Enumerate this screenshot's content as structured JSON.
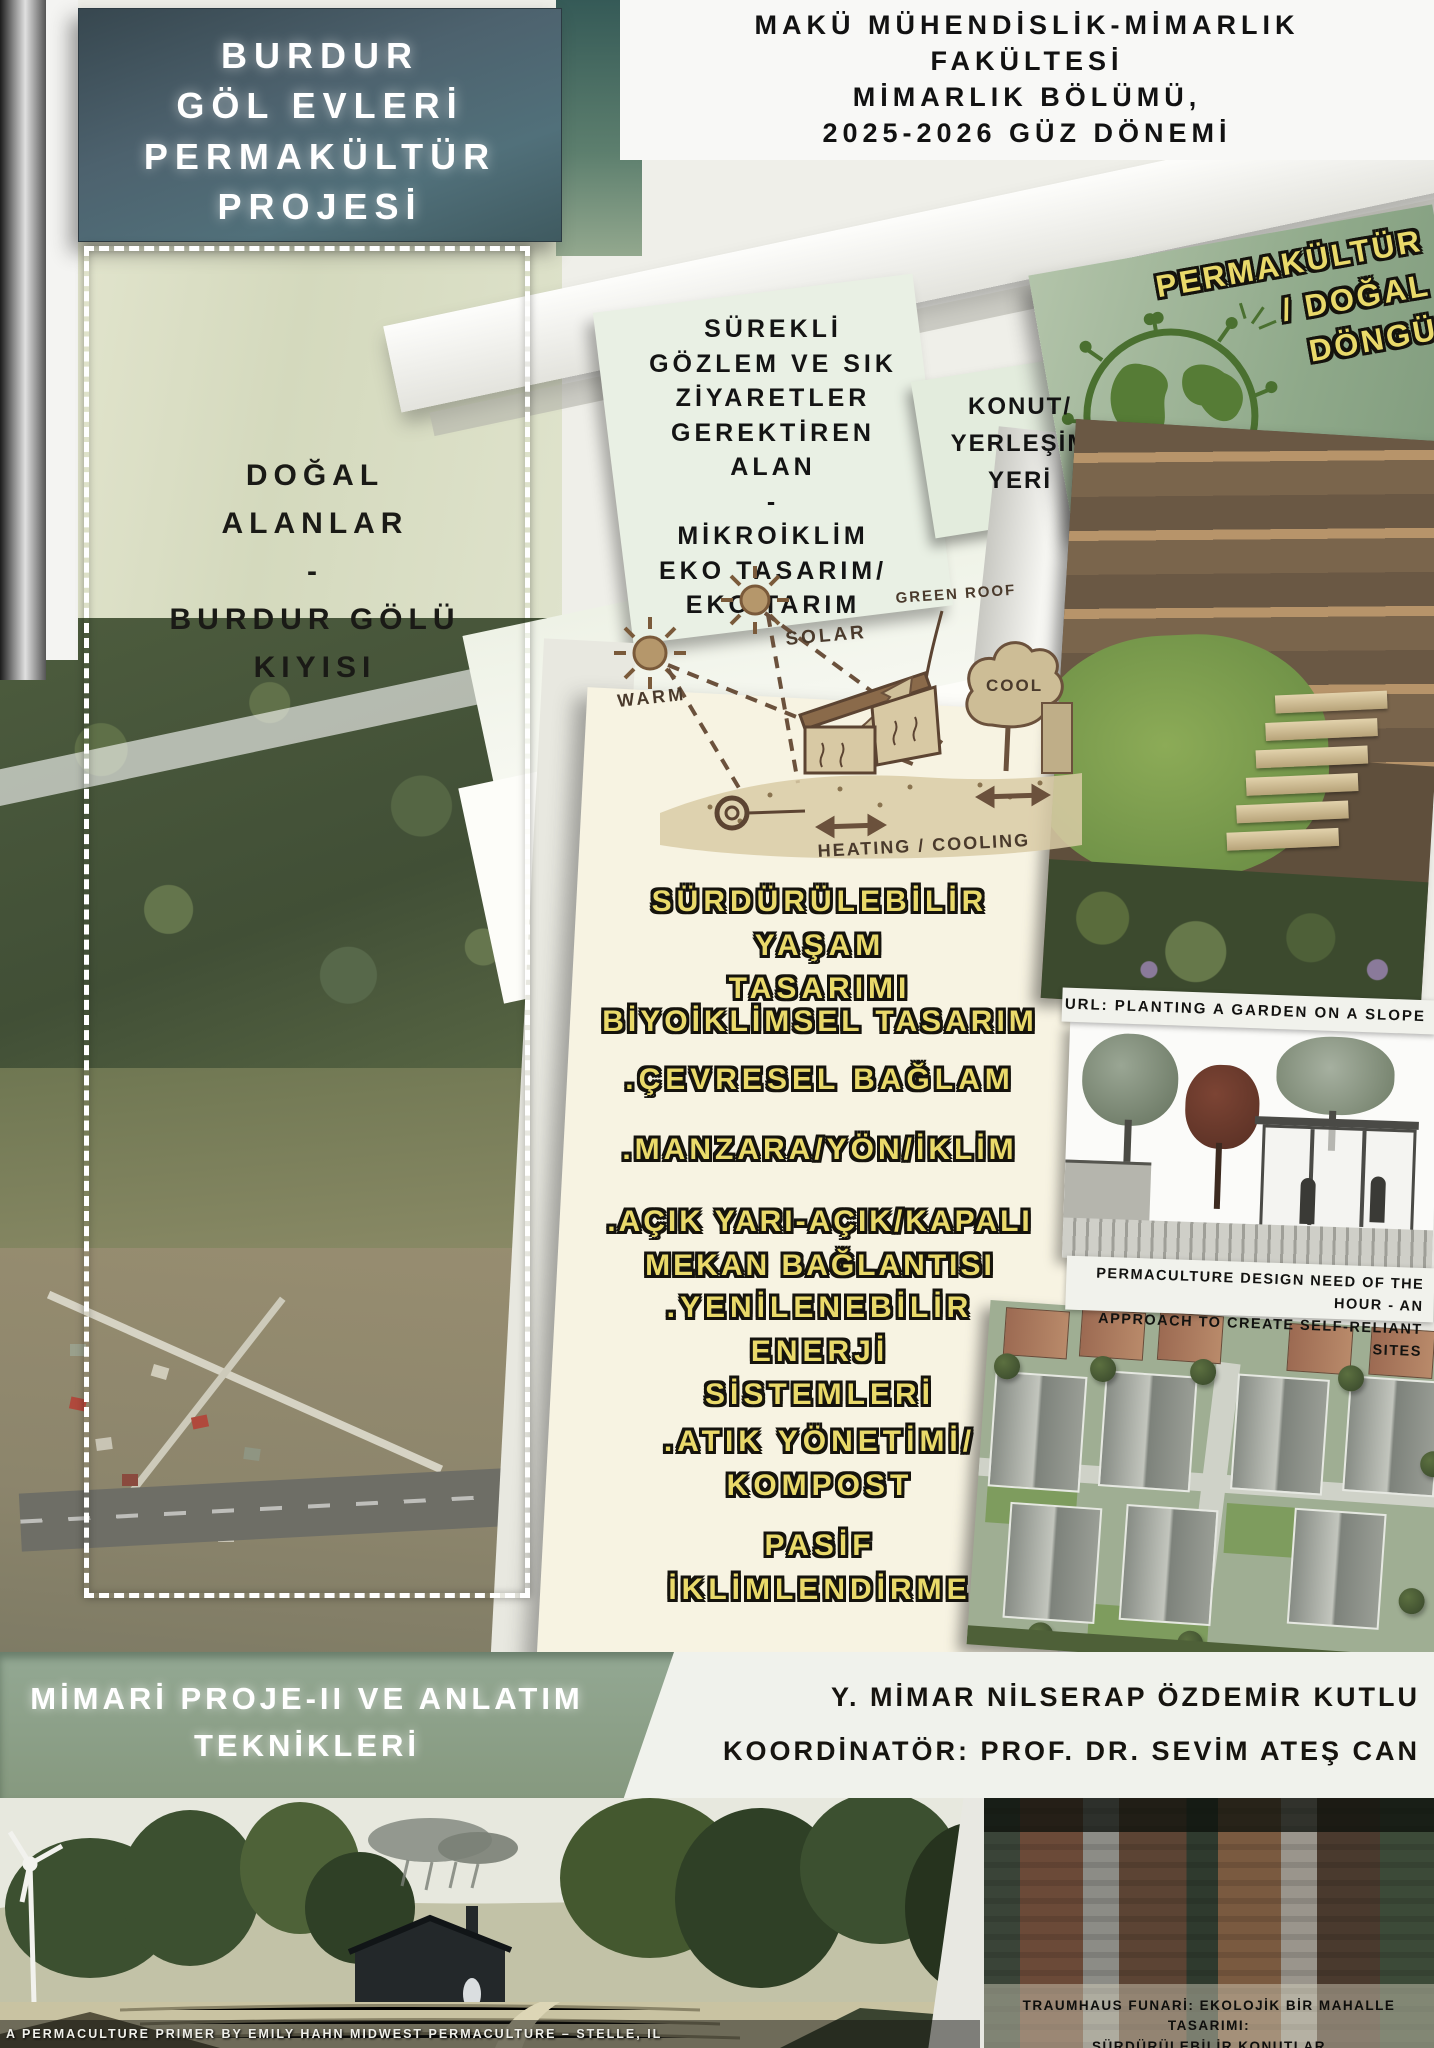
{
  "header": {
    "project_title": "BURDUR\nGÖL EVLERİ\nPERMAKÜLTÜR\nPROJESİ",
    "faculty_info": "MAKÜ MÜHENDİSLİK-MİMARLIK\nFAKÜLTESİ\nMİMARLIK BÖLÜMÜ,\n2025-2026 GÜZ DÖNEMİ"
  },
  "panels": {
    "permaculture_cycle": "PERMAKÜLTÜR\n/ DOĞAL\nDÖNGÜ",
    "observation": "SÜREKLİ\nGÖZLEM VE SIK\nZİYARETLER\nGEREKTİREN\nALAN\n-\nMİKROİKLİM\nEKO TASARIM/\nEKO TARIM",
    "housing": "KONUT/\nYERLEŞİM\nYERİ",
    "natural_areas": "DOĞAL\nALANLAR\n-\nBURDUR GÖLÜ\nKIYISI"
  },
  "sketch_labels": {
    "green_roof": "GREEN ROOF",
    "solar": "SOLAR",
    "warm": "WARM",
    "cool": "COOL",
    "heating_cooling": "HEATING / COOLING"
  },
  "principles": [
    "SÜRDÜRÜLEBİLİR\nYAŞAM\nTASARIMI",
    "BİYOİKLİMSEL TASARIM",
    ".ÇEVRESEL BAĞLAM",
    ".MANZARA/YÖN/İKLİM",
    ".AÇIK YARI-AÇIK/KAPALI\nMEKAN BAĞLANTISI",
    ".YENİLENEBİLİR\nENERJİ\nSİSTEMLERİ",
    ".ATIK YÖNETİMİ/\nKOMPOST",
    "PASİF\nİKLİMLENDİRME"
  ],
  "captions": {
    "slope_garden": "URL: PLANTING A GARDEN ON A SLOPE",
    "self_reliant": "PERMACULTURE DESIGN NEED OF THE HOUR - AN\nAPPROACH TO CREATE SELF-RELIANT SITES",
    "traumhaus": "TRAUMHAUS FUNARİ: EKOLOJİK BİR MAHALLE TASARIMI:\nSÜRDÜRÜLEBİLİR KONUTLAR",
    "primer_credit": "A PERMACULTURE PRIMER BY EMILY HAHN MIDWEST PERMACULTURE – STELLE, IL"
  },
  "footer": {
    "course_title": "MİMARİ PROJE-II VE ANLATIM\nTEKNİKLERİ",
    "author": "Y. MİMAR NİLSERAP ÖZDEMİR KUTLU",
    "coordinator": "KOORDİNATÖR: PROF. DR. SEVİM ATEŞ CAN"
  },
  "colors": {
    "accent_yellow": "#e9d96a",
    "sage_panel": "#9db292",
    "cream_panel": "#f6f2df",
    "footer_band": "#8ba38c",
    "title_panel": "#455a64"
  }
}
